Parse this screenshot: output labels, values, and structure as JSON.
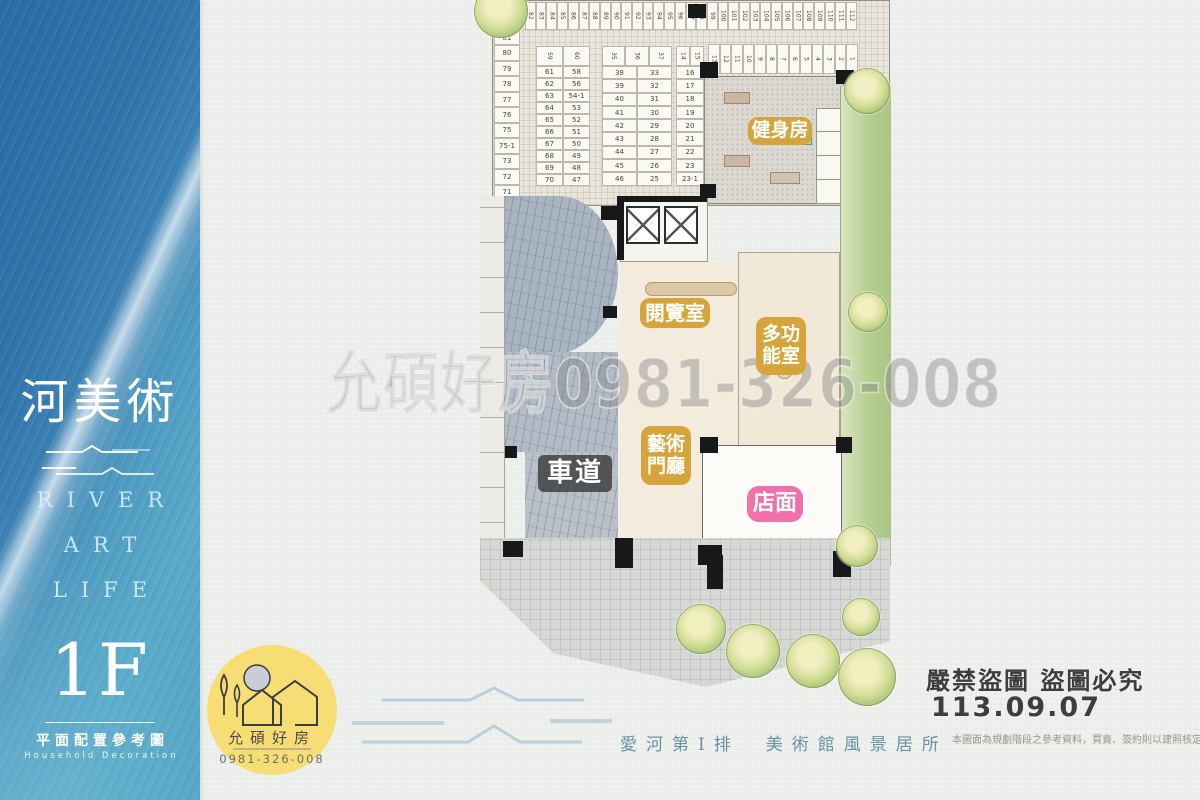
{
  "sidebar": {
    "title": "河美術",
    "river": "RIVER",
    "art": "ART",
    "life": "LIFE",
    "floor": "1F",
    "caption_zh": "平面配置參考圖",
    "caption_en": "Household Decoration"
  },
  "plan": {
    "labels": {
      "gym": "健身房",
      "reading": "閱覽室",
      "multi_line1": "多功",
      "multi_line2": "能室",
      "art_line1": "藝術",
      "art_line2": "門廳",
      "driveway": "車道",
      "store": "店面"
    },
    "parking": {
      "top_row": [
        "82",
        "83",
        "84",
        "85",
        "86",
        "87",
        "88",
        "89",
        "90",
        "91",
        "92",
        "93",
        "94",
        "95",
        "96",
        "97",
        "98",
        "99",
        "100",
        "101",
        "102",
        "103",
        "104",
        "105",
        "106",
        "107",
        "108",
        "109",
        "110",
        "111",
        "112"
      ],
      "left_col": [
        "81",
        "80",
        "79",
        "78",
        "77",
        "76",
        "75",
        "75-1",
        "73",
        "72",
        "71"
      ],
      "row2": [
        "13",
        "12",
        "11",
        "10",
        "9",
        "8",
        "7",
        "6",
        "5",
        "4",
        "3",
        "2",
        "1"
      ],
      "block1_header": [
        "59",
        "60"
      ],
      "block1": [
        [
          "61",
          "58"
        ],
        [
          "62",
          "56"
        ],
        [
          "63",
          "54-1"
        ],
        [
          "64",
          "53"
        ],
        [
          "65",
          "52"
        ],
        [
          "66",
          "51"
        ],
        [
          "67",
          "50"
        ],
        [
          "68",
          "49"
        ],
        [
          "69",
          "48"
        ],
        [
          "70",
          "47"
        ]
      ],
      "block2_header": [
        "35",
        "36",
        "37"
      ],
      "block2": [
        [
          "38",
          "33"
        ],
        [
          "39",
          "32"
        ],
        [
          "40",
          "31"
        ],
        [
          "41",
          "30"
        ],
        [
          "42",
          "29"
        ],
        [
          "43",
          "28"
        ],
        [
          "44",
          "27"
        ],
        [
          "45",
          "26"
        ],
        [
          "46",
          "25"
        ]
      ],
      "block3_header": [
        "14",
        "15"
      ],
      "block3": [
        "16",
        "17",
        "18",
        "19",
        "20",
        "21",
        "22",
        "23",
        "23-1"
      ]
    }
  },
  "watermark": "允碩好房0981-326-008",
  "logo": {
    "name": "允碩好房",
    "phone": "0981-326-008"
  },
  "tagline": "愛河第Ⅰ排　美術館風景居所",
  "footer": {
    "warning": "嚴禁盜圖 盜圖必究",
    "date": "113.09.07",
    "disclaimer": "本圖面為規劃階段之參考資料，買賣、簽約則以建照核定之圖"
  },
  "colors": {
    "badge_gold": "#d7a43c",
    "badge_pink": "#f070ab",
    "badge_dark": "#444446",
    "sidebar_blue": "#3c83b4",
    "tagline_teal": "#68929f",
    "logo_yellow": "#f7de74"
  }
}
